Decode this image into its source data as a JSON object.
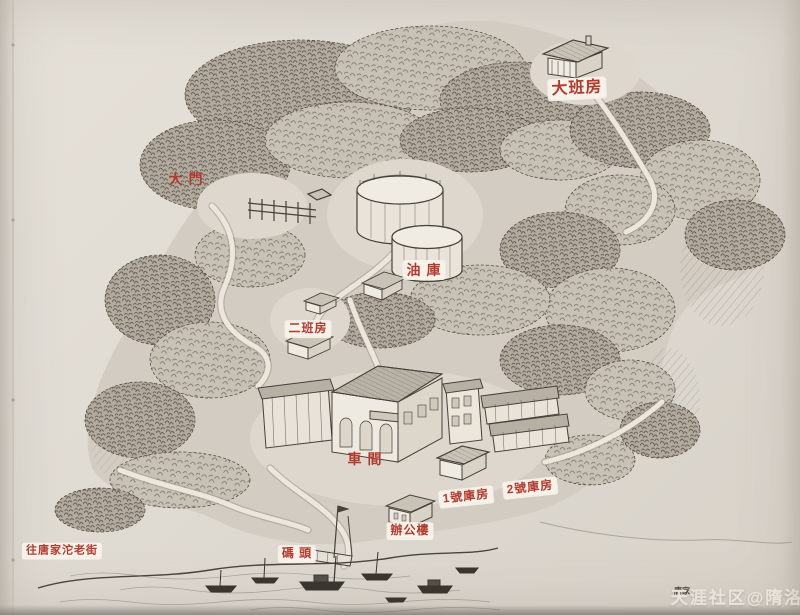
{
  "page": {
    "background_top": "#e6e1d9",
    "background_bottom": "#d8d2c9",
    "ink_color": "#45403a",
    "label_red": "#b43a2e",
    "label_box_color": "#f7f3eb",
    "watermark_color": "#e9e4da",
    "caption_color": "#4a443c"
  },
  "map": {
    "type": "hand-drawn-birdseye-map",
    "labels": [
      {
        "id": "daban-fang",
        "text": "大班房",
        "x": 577,
        "y": 89,
        "size": 16,
        "boxed": true,
        "rot": -3
      },
      {
        "id": "da-men",
        "text": "大 門",
        "x": 186,
        "y": 179,
        "size": 14,
        "boxed": false,
        "rot": 0
      },
      {
        "id": "you-ku",
        "text": "油 庫",
        "x": 424,
        "y": 270,
        "size": 14,
        "boxed": true,
        "rot": 0
      },
      {
        "id": "erban-fang",
        "text": "二班房",
        "x": 308,
        "y": 329,
        "size": 12,
        "boxed": true,
        "rot": 0
      },
      {
        "id": "che-jian",
        "text": "車 間",
        "x": 365,
        "y": 459,
        "size": 14,
        "boxed": false,
        "rot": 0
      },
      {
        "id": "no1-kufang",
        "text": "1號庫房",
        "x": 466,
        "y": 497,
        "size": 12,
        "boxed": true,
        "rot": -6
      },
      {
        "id": "no2-kufang",
        "text": "2號庫房",
        "x": 530,
        "y": 488,
        "size": 12,
        "boxed": true,
        "rot": -6
      },
      {
        "id": "bangong-lou",
        "text": "辦公樓",
        "x": 410,
        "y": 531,
        "size": 12,
        "boxed": true,
        "rot": 0
      },
      {
        "id": "ma-tou",
        "text": "碼 頭",
        "x": 297,
        "y": 554,
        "size": 12,
        "boxed": true,
        "rot": 0
      },
      {
        "id": "wang-tangjiatuo-laojie",
        "text": "往唐家沱老街",
        "x": 62,
        "y": 551,
        "size": 11,
        "boxed": true,
        "rot": 0
      }
    ]
  },
  "caption": {
    "text": "唐家",
    "x": 682,
    "y": 591
  },
  "watermark": {
    "text": "天涯社区@隋洛",
    "x": 737,
    "y": 596
  }
}
